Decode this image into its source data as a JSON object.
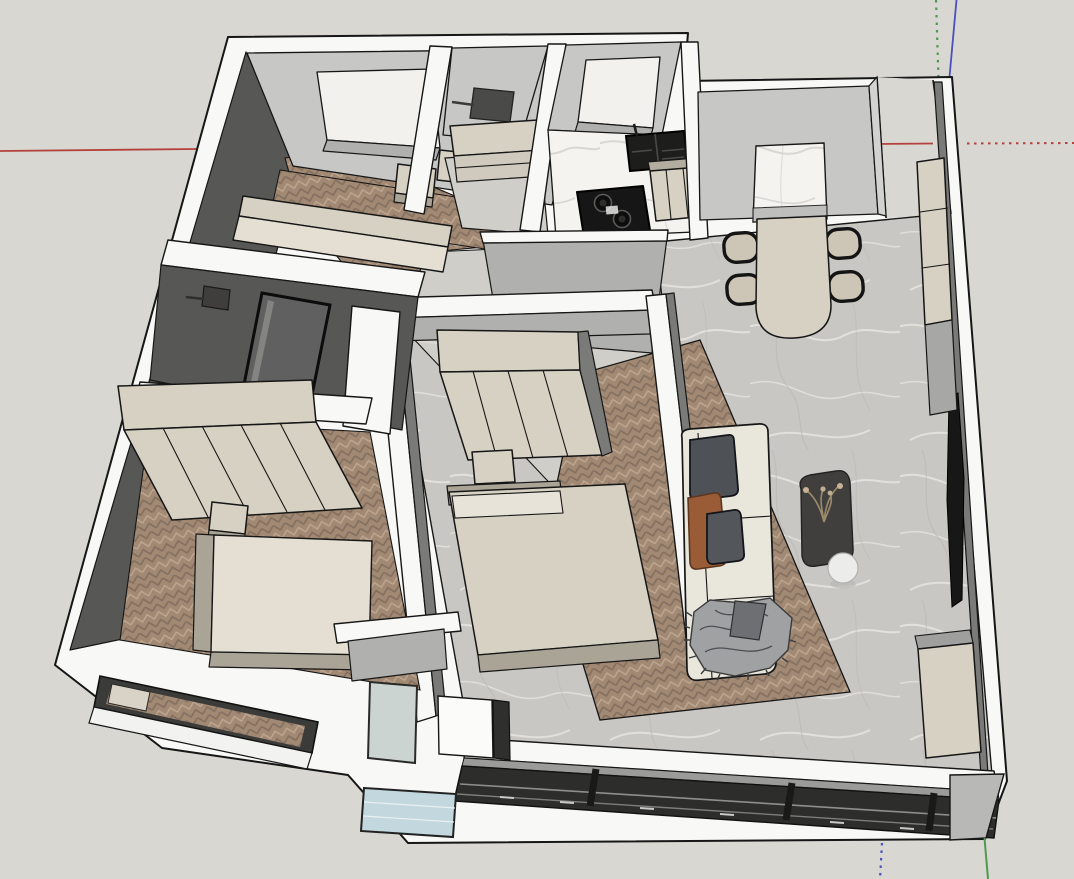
{
  "viewport": {
    "app_kind": "3d-modeling-viewport",
    "content": "sketchup-style axonometric view of a furnished apartment model"
  },
  "palette": {
    "bg": "#d8d7d2",
    "line": "#161616",
    "wallTop": "#f8f8f6",
    "wallLight": "#c7c7c5",
    "wallMid": "#b0b0ae",
    "wallDark": "#7a7a78",
    "wallDeep": "#575756",
    "beige": "#d6d1c3",
    "beigeDark": "#aaa496",
    "charcoal": "#3f3e3c",
    "woodBase": "#a18974",
    "woodDark": "#84705f",
    "woodLight": "#bfa892",
    "marbleBase": "#c9c7c3",
    "marbleVein": "#e6e4e0",
    "marbleWhiteBase": "#f4f3f0",
    "marbleWhiteVein": "#d9d7d3",
    "tileLight": "#d0cec9",
    "glassCorner": "#ccd4d2",
    "glassBalcony": "#c2d8de",
    "sofaCream": "#e9e6dc",
    "pillowDark": "#4e5257",
    "pillowRust": "#9a5c36",
    "throwGray": "#a0a1a3",
    "axisRed": "#b5413c",
    "axisGreen": "#4f9a4f",
    "axisBlue": "#4b50bd"
  },
  "axes": {
    "red_style_solid": "positive",
    "red_style_dotted": "negative",
    "green_style_dotted": "negative",
    "green_style_solid": "positive",
    "blue_style_solid": "positive",
    "blue_style_dotted": "negative"
  },
  "scene": {
    "objects": [
      "apartment-shell",
      "bedroom-top-left",
      "bathroom-top",
      "kitchen",
      "dining-area",
      "living-room",
      "bedroom-center",
      "bedroom-left",
      "bathroom-middle",
      "balcony",
      "entry-corridor",
      "bed",
      "wardrobe",
      "nightstand",
      "dining-table",
      "dining-chairs",
      "tall-cabinet",
      "sideboard",
      "sofa",
      "pillows",
      "throw-blanket",
      "coffee-table",
      "dried-plant",
      "side-table",
      "tv-panel",
      "cooktop",
      "sink",
      "kitchen-cabinets",
      "washing-machine",
      "shower-glass",
      "window-wall",
      "corner-window"
    ]
  }
}
